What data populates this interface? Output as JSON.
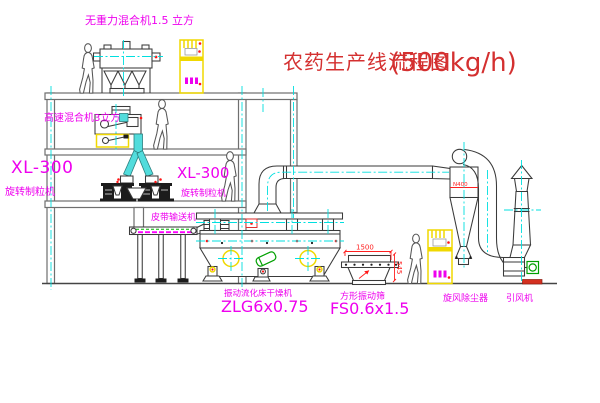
{
  "canvas": {
    "width": 600,
    "height": 403,
    "background": "#ffffff"
  },
  "palette": {
    "frame_gray": "#6f6f6f",
    "machine_line": "#3a3a3a",
    "centerline_cyan": "#00dfdf",
    "label_magenta": "#ee00ee",
    "title_red": "#d43030",
    "dimension_red": "#ff2020",
    "cabinet_yellow": "#f0d800",
    "motor_green": "#00a000"
  },
  "title": {
    "cn": "农药生产线流程图",
    "rate": "(500kg/h)"
  },
  "equipment_labels": {
    "gravity_mixer": "无重力混合机1.5 立方",
    "high_speed_mixer": "高速混合机3立方",
    "granulator_left": {
      "model": "XL-300",
      "name": "旋转制粒机"
    },
    "granulator_right": {
      "model": "XL-300",
      "name": "旋转制粒机"
    },
    "belt_conveyor": "皮带输送机",
    "fluid_bed_dryer": {
      "name": "振动流化床干燥机",
      "model": "ZLG6x0.75"
    },
    "square_sieve": {
      "name": "方形振动筛",
      "model": "FS0.6x1.5"
    },
    "cyclone": "旋风除尘器",
    "induced_draft_fan": "引风机"
  },
  "dimensions": {
    "sieve_length": "1500",
    "sieve_height": "545",
    "cyclone_label": "N400"
  }
}
